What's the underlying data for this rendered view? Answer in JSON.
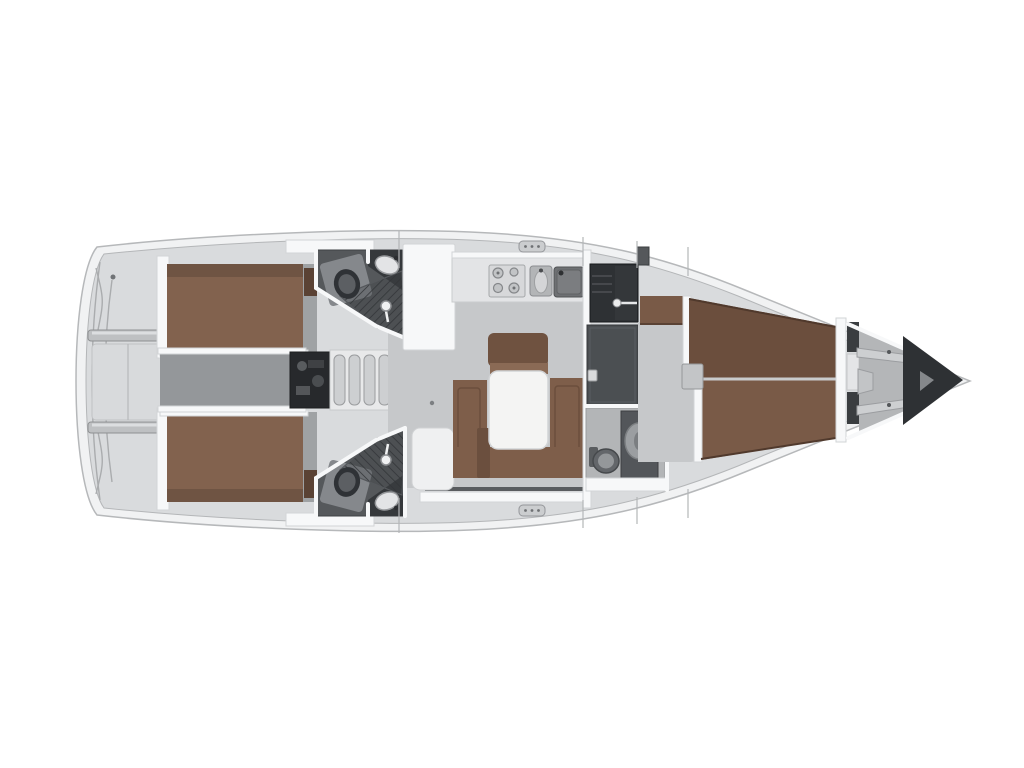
{
  "diagram": {
    "type": "floor-plan",
    "subject": "sailing-yacht-interior-layout",
    "orientation": "bow-right",
    "rooms": [
      "stern-platform",
      "aft-cabin-port",
      "aft-cabin-starboard",
      "aft-corridor",
      "engine-compartment",
      "companionway-steps",
      "head-port-aft",
      "head-starboard-aft",
      "galley",
      "salon",
      "wet-locker",
      "wardrobe",
      "head-forward",
      "hallway",
      "forward-cabin",
      "forepeak",
      "anchor-locker"
    ],
    "fixtures": [
      "toilet-icon",
      "washbasin-icon",
      "shower-icon",
      "stove-burners-icon",
      "sink-icon",
      "dinette-table",
      "u-shaped-sofa",
      "double-berth",
      "v-berth",
      "deck-hatch-icon",
      "step-treads"
    ]
  },
  "colors": {
    "background": "#ffffff",
    "hull_rim": "#f1f2f3",
    "hull_stroke": "#b6b8ba",
    "deck": "#d9dbdd",
    "deck_seam": "#b4b6b8",
    "wall_white": "#f7f8f9",
    "wall_stroke": "#d2d4d6",
    "floor": "#c6c8ca",
    "corridor": "#94979a",
    "berth_brown": "#82624e",
    "berth_brown_dark": "#6b4e3d",
    "berth_brown_mid": "#795a47",
    "sofa_brown": "#7e5e4a",
    "backrest_brown": "#6f5240",
    "table_white": "#f4f4f3",
    "charcoal": "#3a3d40",
    "dark_locker": "#2e3134",
    "wardrobe_gray": "#4b4f52",
    "fixture_gray": "#9da0a3",
    "fixture_light": "#dcdddf",
    "shower_dark": "#3f4246",
    "shower_stripe": "#2c2f32",
    "steps_gray": "#cdcfd1",
    "bench_gray": "#bec0c2",
    "engine_dark": "#27292c"
  }
}
